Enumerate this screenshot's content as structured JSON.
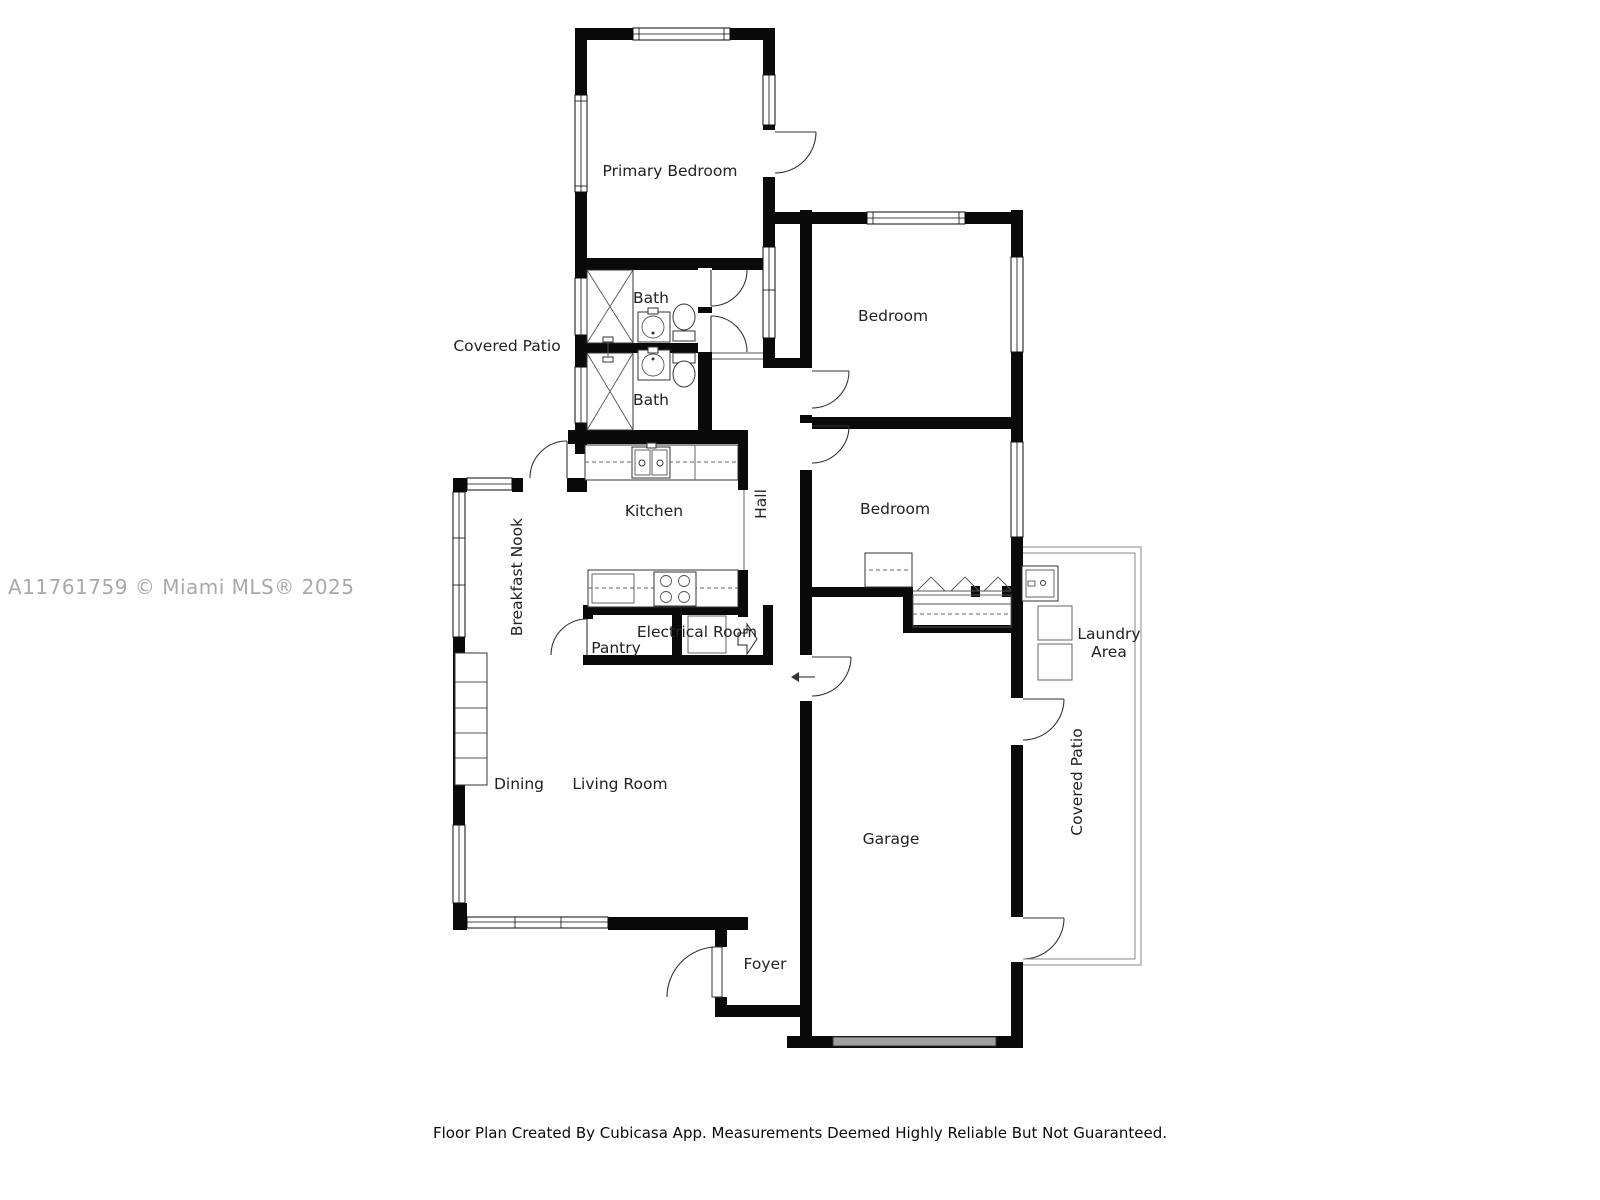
{
  "watermark": "A11761759 © Miami MLS® 2025",
  "footer": "Floor Plan Created By Cubicasa App. Measurements Deemed Highly Reliable But Not Guaranteed.",
  "rooms": [
    {
      "name": "primary-bedroom",
      "label": "Primary Bedroom",
      "x": 670,
      "y": 176,
      "rot": 0
    },
    {
      "name": "bath-top",
      "label": "Bath",
      "x": 651,
      "y": 303,
      "rot": 0
    },
    {
      "name": "bath-bottom",
      "label": "Bath",
      "x": 651,
      "y": 405,
      "rot": 0
    },
    {
      "name": "covered-patio-left",
      "label": "Covered Patio",
      "x": 507,
      "y": 351,
      "rot": 0
    },
    {
      "name": "kitchen",
      "label": "Kitchen",
      "x": 654,
      "y": 516,
      "rot": 0
    },
    {
      "name": "breakfast-nook",
      "label": "Breakfast Nook",
      "x": 522,
      "y": 577,
      "rot": -90
    },
    {
      "name": "hall",
      "label": "Hall",
      "x": 766,
      "y": 504,
      "rot": -90
    },
    {
      "name": "bedroom-top",
      "label": "Bedroom",
      "x": 893,
      "y": 321,
      "rot": 0
    },
    {
      "name": "bedroom-middle",
      "label": "Bedroom",
      "x": 895,
      "y": 514,
      "rot": 0
    },
    {
      "name": "pantry",
      "label": "Pantry",
      "x": 616,
      "y": 653,
      "rot": 0
    },
    {
      "name": "electrical-room",
      "label": "Electrical Room",
      "x": 697,
      "y": 637,
      "rot": 0
    },
    {
      "name": "laundry-area-line1",
      "label": "Laundry",
      "x": 1109,
      "y": 639,
      "rot": 0
    },
    {
      "name": "laundry-area-line2",
      "label": "Area",
      "x": 1109,
      "y": 657,
      "rot": 0
    },
    {
      "name": "dining",
      "label": "Dining",
      "x": 519,
      "y": 789,
      "rot": 0
    },
    {
      "name": "living-room",
      "label": "Living Room",
      "x": 620,
      "y": 789,
      "rot": 0
    },
    {
      "name": "garage",
      "label": "Garage",
      "x": 891,
      "y": 844,
      "rot": 0
    },
    {
      "name": "covered-patio-right",
      "label": "Covered Patio",
      "x": 1082,
      "y": 782,
      "rot": -90
    },
    {
      "name": "foyer",
      "label": "Foyer",
      "x": 765,
      "y": 969,
      "rot": 0
    }
  ]
}
